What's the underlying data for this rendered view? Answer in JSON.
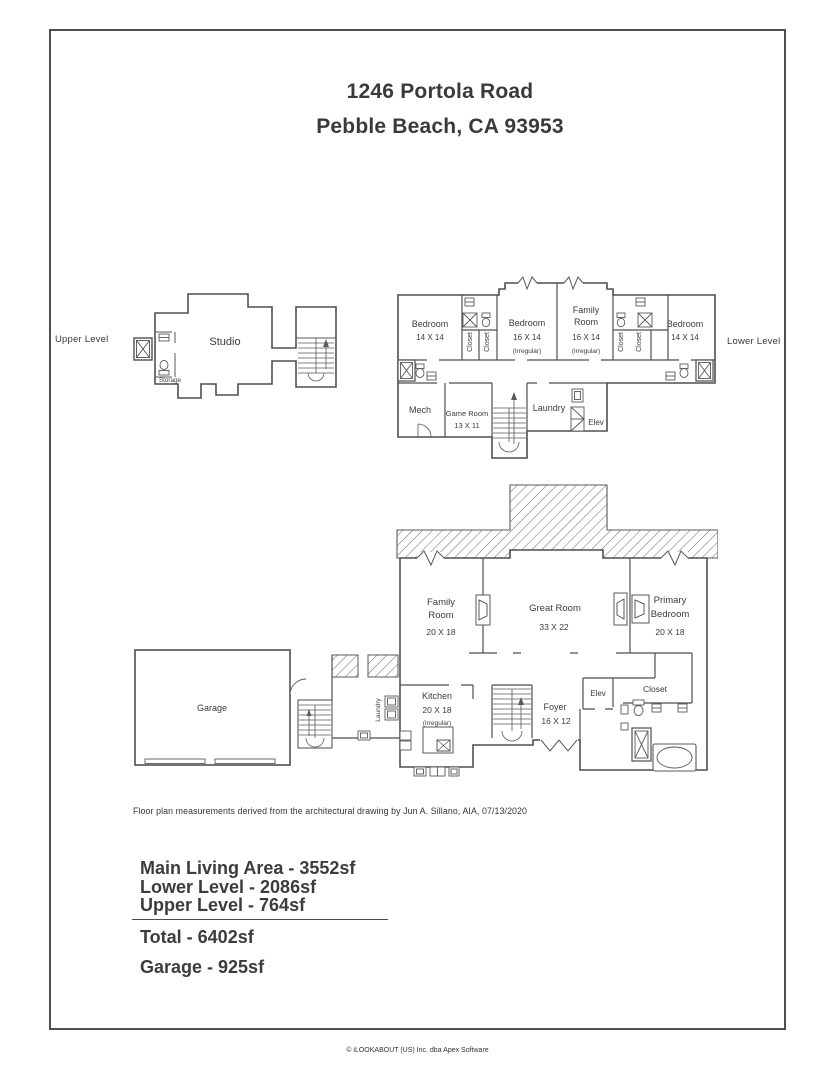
{
  "page": {
    "title1": "1246 Portola Road",
    "title2": "Pebble Beach, CA 93953",
    "note": "Floor plan measurements derived from the architectural drawing by Jun A. Sillano, AIA, 07/13/2020",
    "copyright": "© iLOOKABOUT (US) Inc. dba Apex Software"
  },
  "levels": {
    "upper": "Upper Level",
    "lower": "Lower Level"
  },
  "plans": {
    "upper": {
      "studio": "Studio",
      "storage": "Storage"
    },
    "lower": {
      "bedroom_left": {
        "name": "Bedroom",
        "dims": "14 X 14"
      },
      "bedroom_mid": {
        "name": "Bedroom",
        "dims": "16 X 14",
        "note": "(Irregular)"
      },
      "family": {
        "line1": "Family",
        "line2": "Room",
        "dims": "16 X 14",
        "note": "(Irregular)"
      },
      "bedroom_right": {
        "name": "Bedroom",
        "dims": "14 X 14"
      },
      "closet": "Closet",
      "mech": "Mech",
      "game": {
        "name": "Game Room",
        "dims": "13 X 11"
      },
      "laundry": "Laundry",
      "elev": "Elev"
    },
    "main": {
      "family": {
        "line1": "Family",
        "line2": "Room",
        "dims": "20 X 18"
      },
      "great": {
        "name": "Great Room",
        "dims": "33 X 22"
      },
      "primary": {
        "line1": "Primary",
        "line2": "Bedroom",
        "dims": "20 X 18"
      },
      "kitchen": {
        "name": "Kitchen",
        "dims": "20 X 18",
        "note": "(Irregular)"
      },
      "foyer": {
        "name": "Foyer",
        "dims": "16 X 12"
      },
      "elev": "Elev",
      "closet": "Closet",
      "garage": "Garage",
      "laundry": "Laundry"
    }
  },
  "summary": {
    "main_living": "Main Living Area - 3552sf",
    "lower": "Lower Level - 2086sf",
    "upper": "Upper Level - 764sf",
    "total": "Total - 6402sf",
    "garage": "Garage - 925sf"
  },
  "colors": {
    "wall": "#4f4f4f",
    "text": "#3b3b3b"
  }
}
